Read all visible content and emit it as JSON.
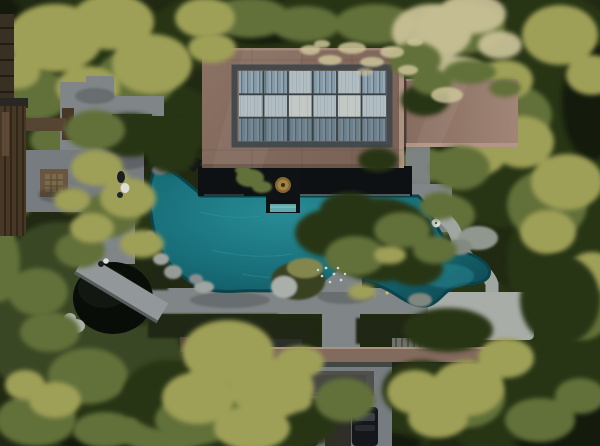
{
  "scene": {
    "type": "aerial-drone-photograph",
    "description": "Top-down aerial view of a modern garden pavilion with a bronze roof and gridded glass skylight, a free-form turquoise swimming pool with a black deck and pier holding a bronze bowl, gray stone plazas and paths, a black circular pond crossed by a diagonal bridge, a bronze canopy walkway, two parked cars at an entry court, lounge chairs on a terrace, and dense green and yellow-green tree canopies",
    "elements": {
      "main_roof": "bronze pavilion roof",
      "skylight": "gridded glass skylight",
      "wing_roof": "bronze roof wing",
      "pool": "turquoise free-form pool",
      "stream": "turquoise stream arm",
      "deck": "black reflecting deck",
      "pier": "black pier with bronze bowl",
      "pond": "black circular pond",
      "bridge": "diagonal stone bridge",
      "canopy": "bronze canopy walkway",
      "entry_plaza": "entry court with two cars",
      "terrace": "terrace with chairs and table",
      "person": "visitor with stroller"
    }
  },
  "palette": {
    "ground_dark": "#232c14",
    "lawn": "#3e4c26",
    "lawn_dark": "#2c3719",
    "tree_dark": "#2c3718",
    "tree_deep": "#151b0c",
    "tree_mid": "#68773c",
    "tree_bright": "#a7a95b",
    "tree_blossom": "#d8cfa2",
    "path_gray": "#878d90",
    "path_light": "#b3b7b2",
    "plaza_gray": "#7d8386",
    "plaza_inset": "#54554e",
    "pool_light": "#2a949e",
    "pool_mid": "#1a7681",
    "pool_dark": "#11535e",
    "pool_edge": "#0c4750",
    "ripple": "#3aa0a8",
    "deck_black": "#0e1215",
    "steps_teal": "#66b3b8",
    "roof_bronze": "#8b7164",
    "roof_light": "#a58b7a",
    "roof_fascia": "#b59a89",
    "wing_bronze": "#957a6b",
    "wing_light": "#aa8d7d",
    "skylight_frame": "#474d51",
    "glass_light": "#bcc8cd",
    "glass_streak": "#9db0bc",
    "glass_cream": "#cdd3cf",
    "canopy_bronze": "#8a7062",
    "bench_brown": "#57463a",
    "slat_gray": "#757a70",
    "hedge_dark": "#222b15",
    "water_black": "#0a0e09",
    "bronze_inset": "#6e5b46",
    "bowl_gold": "#ad8a45",
    "stone_light": "#aeb3af",
    "car_dark": "#17191c",
    "car_glass": "#3e444b",
    "walkway_dark": "#33312c",
    "chair_dark": "#33404a",
    "white": "#e9eae4",
    "duck_white": "#d9e7e2",
    "lamp_warm": "#e6c27a",
    "wood_brown": "#4b3a28"
  }
}
